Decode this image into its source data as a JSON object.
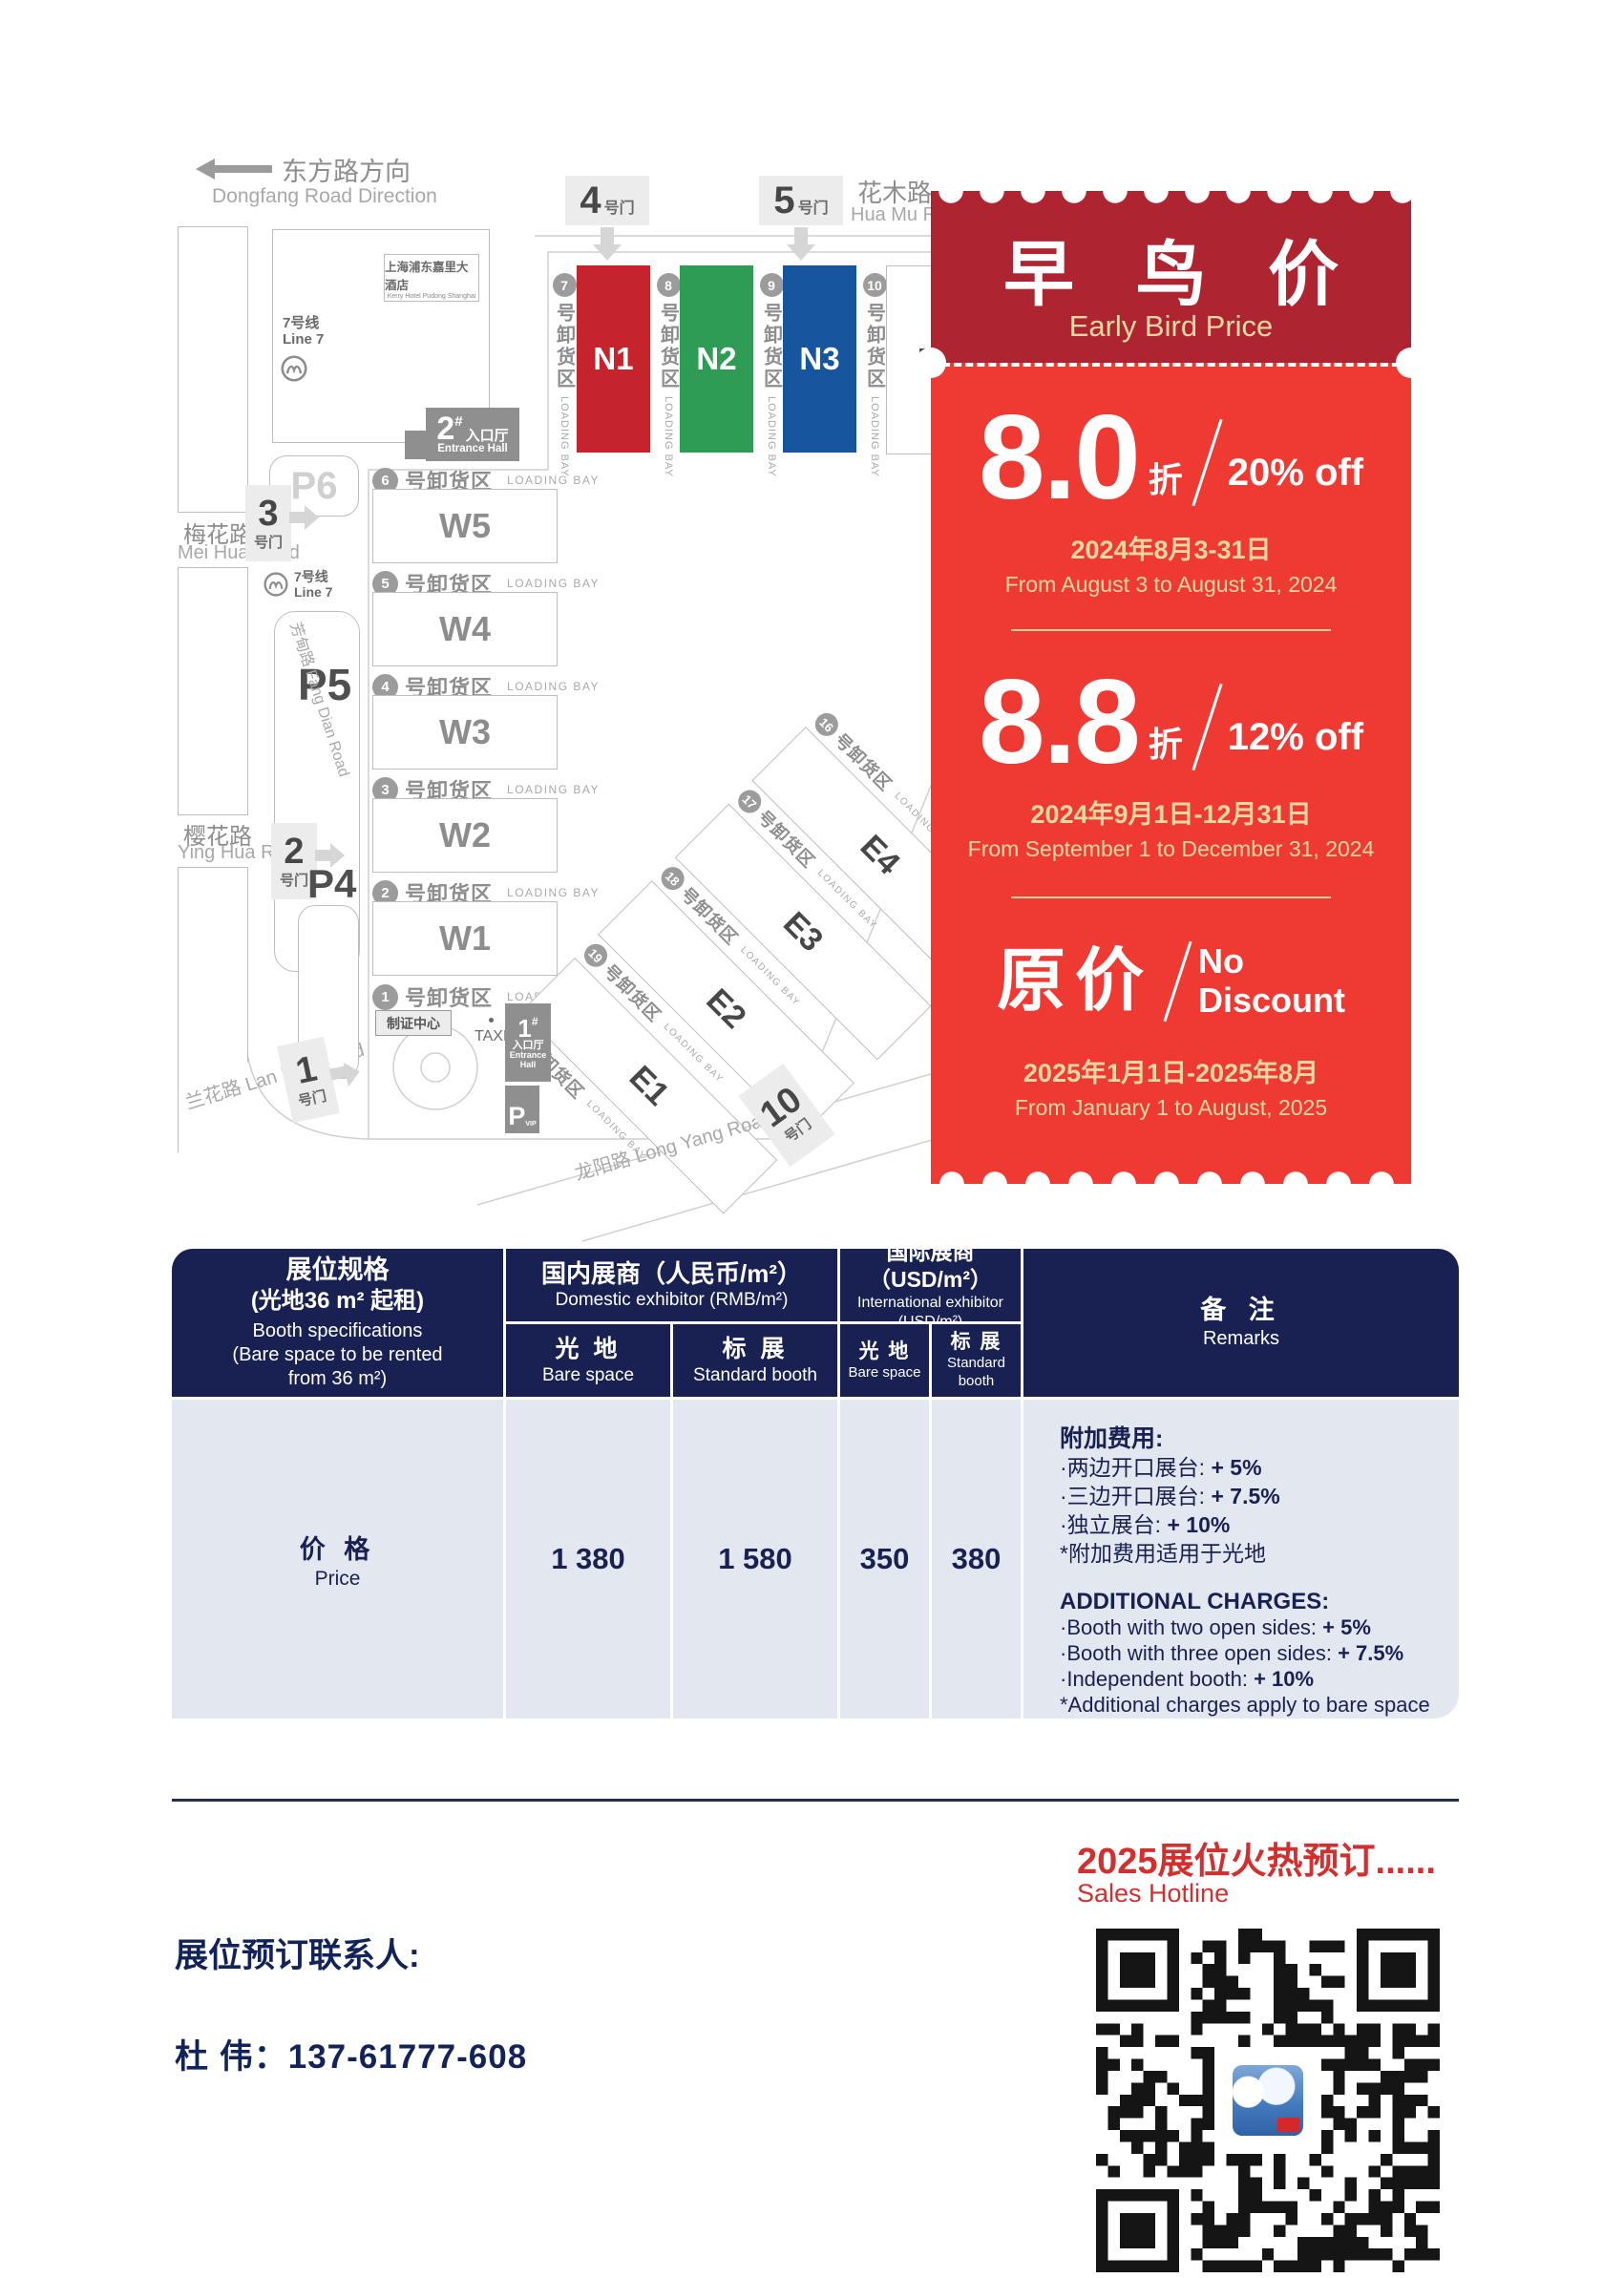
{
  "map": {
    "direction_zh": "东方路方向",
    "direction_en": "Dongfang Road Direction",
    "hotel_zh": "上海浦东嘉里大酒店",
    "hotel_en": "Kerry Hotel Pudong Shanghai",
    "metro_zh": "7号线",
    "metro_en": "Line 7",
    "bay_zh": "号卸货区",
    "bay_en": "LOADING BAY",
    "gate_suffix": "号门",
    "gates": {
      "g1": "1",
      "g2": "2",
      "g3": "3",
      "g4": "4",
      "g5": "5",
      "g10": "10"
    },
    "roads": {
      "huamu_zh": "花木路",
      "huamu_en": "Hua Mu Road",
      "meihua_zh": "梅花路",
      "meihua_en": "Mei Hua Road",
      "fangdian": "芳甸路 Fang Dian Road",
      "yinghua_zh": "樱花路",
      "yinghua_en": "Ying Hua Road",
      "lanhua": "兰花路 Lan Hua Road",
      "longyang": "龙阳路 Long Yang Road"
    },
    "parking": {
      "p4": "P4",
      "p5": "P5",
      "p6": "P6",
      "vip": "P",
      "vip_sub": "VIP"
    },
    "entrance2_num": "2",
    "entrance1_num": "1",
    "entrance_hash": "#",
    "entrance_zh": "入口厅",
    "entrance_en": "Entrance Hall",
    "entrance_en1": "Entrance",
    "entrance_en2": "Hall",
    "taxi": "TAXI",
    "badge": "制证中心",
    "halls_n": [
      "N1",
      "N2",
      "N3",
      "N4"
    ],
    "halls_w": [
      "W5",
      "W4",
      "W3",
      "W2",
      "W1"
    ],
    "halls_e": [
      "E4",
      "E3",
      "E2",
      "E1"
    ],
    "bays_n": [
      "7",
      "8",
      "9",
      "10"
    ],
    "bays_w": [
      "6",
      "5",
      "4",
      "3",
      "2",
      "1"
    ],
    "bays_e": [
      "16",
      "17",
      "18",
      "19",
      "20"
    ]
  },
  "coupon": {
    "title_zh": "早 鸟 价",
    "title_en": "Early Bird Price",
    "tier1": {
      "num": "8.0",
      "unit": "折",
      "pct": "20% off",
      "date_zh": "2024年8月3-31日",
      "date_en": "From August 3 to August 31, 2024"
    },
    "tier2": {
      "num": "8.8",
      "unit": "折",
      "pct": "12% off",
      "date_zh": "2024年9月1日-12月31日",
      "date_en": "From September 1 to December 31, 2024"
    },
    "tier3": {
      "zh": "原价",
      "en1": "No",
      "en2": "Discount",
      "date_zh": "2025年1月1日-2025年8月",
      "date_en": "From January 1 to August, 2025"
    }
  },
  "pricing": {
    "spec_l1": "展位规格",
    "spec_l2": "(光地36 m² 起租)",
    "spec_l3": "Booth specifications",
    "spec_l4": "(Bare space to be rented",
    "spec_l5": "from 36 m²)",
    "dom_zh": "国内展商（人民币/m²）",
    "dom_en": "Domestic exhibitor (RMB/m²)",
    "int_zh": "国际展商（USD/m²）",
    "int_en": "International exhibitor (USD/m²)",
    "bare_zh": "光 地",
    "bare_en": "Bare space",
    "std_zh": "标 展",
    "std_en": "Standard booth",
    "remarks_zh": "备 注",
    "remarks_en": "Remarks",
    "price_zh": "价 格",
    "price_en": "Price",
    "values": [
      "1 380",
      "1 580",
      "350",
      "380"
    ],
    "remarks": {
      "cn_title": "附加费用:",
      "cn_items": [
        {
          "t": "·两边开口展台: ",
          "v": "+ 5%"
        },
        {
          "t": "·三边开口展台: ",
          "v": "+ 7.5%"
        },
        {
          "t": "·独立展台: ",
          "v": "+ 10%"
        }
      ],
      "cn_note": "*附加费用适用于光地",
      "en_title": "ADDITIONAL CHARGES:",
      "en_items": [
        {
          "t": "·Booth with two open sides: ",
          "v": "+ 5%"
        },
        {
          "t": "·Booth with three open sides: ",
          "v": "+ 7.5%"
        },
        {
          "t": "·Independent booth: ",
          "v": "+ 10%"
        }
      ],
      "en_note": "*Additional charges apply to bare space"
    }
  },
  "footer": {
    "hot_zh": "2025展位火热预订......",
    "hot_en": "Sales Hotline",
    "contact_label": "展位预订联系人:",
    "contact": "杜  伟：137-61777-608"
  },
  "colors": {
    "hall_n1": "#c5242c",
    "hall_n2": "#2f9c55",
    "hall_n3": "#17559f",
    "coupon_dark": "#ae2430",
    "coupon_bright": "#ee3a33",
    "coupon_gold": "#e8d9a2",
    "table_navy": "#192153",
    "table_body": "#e3e7ef",
    "accent_red": "#d22f2f",
    "navy_text": "#12235a"
  }
}
